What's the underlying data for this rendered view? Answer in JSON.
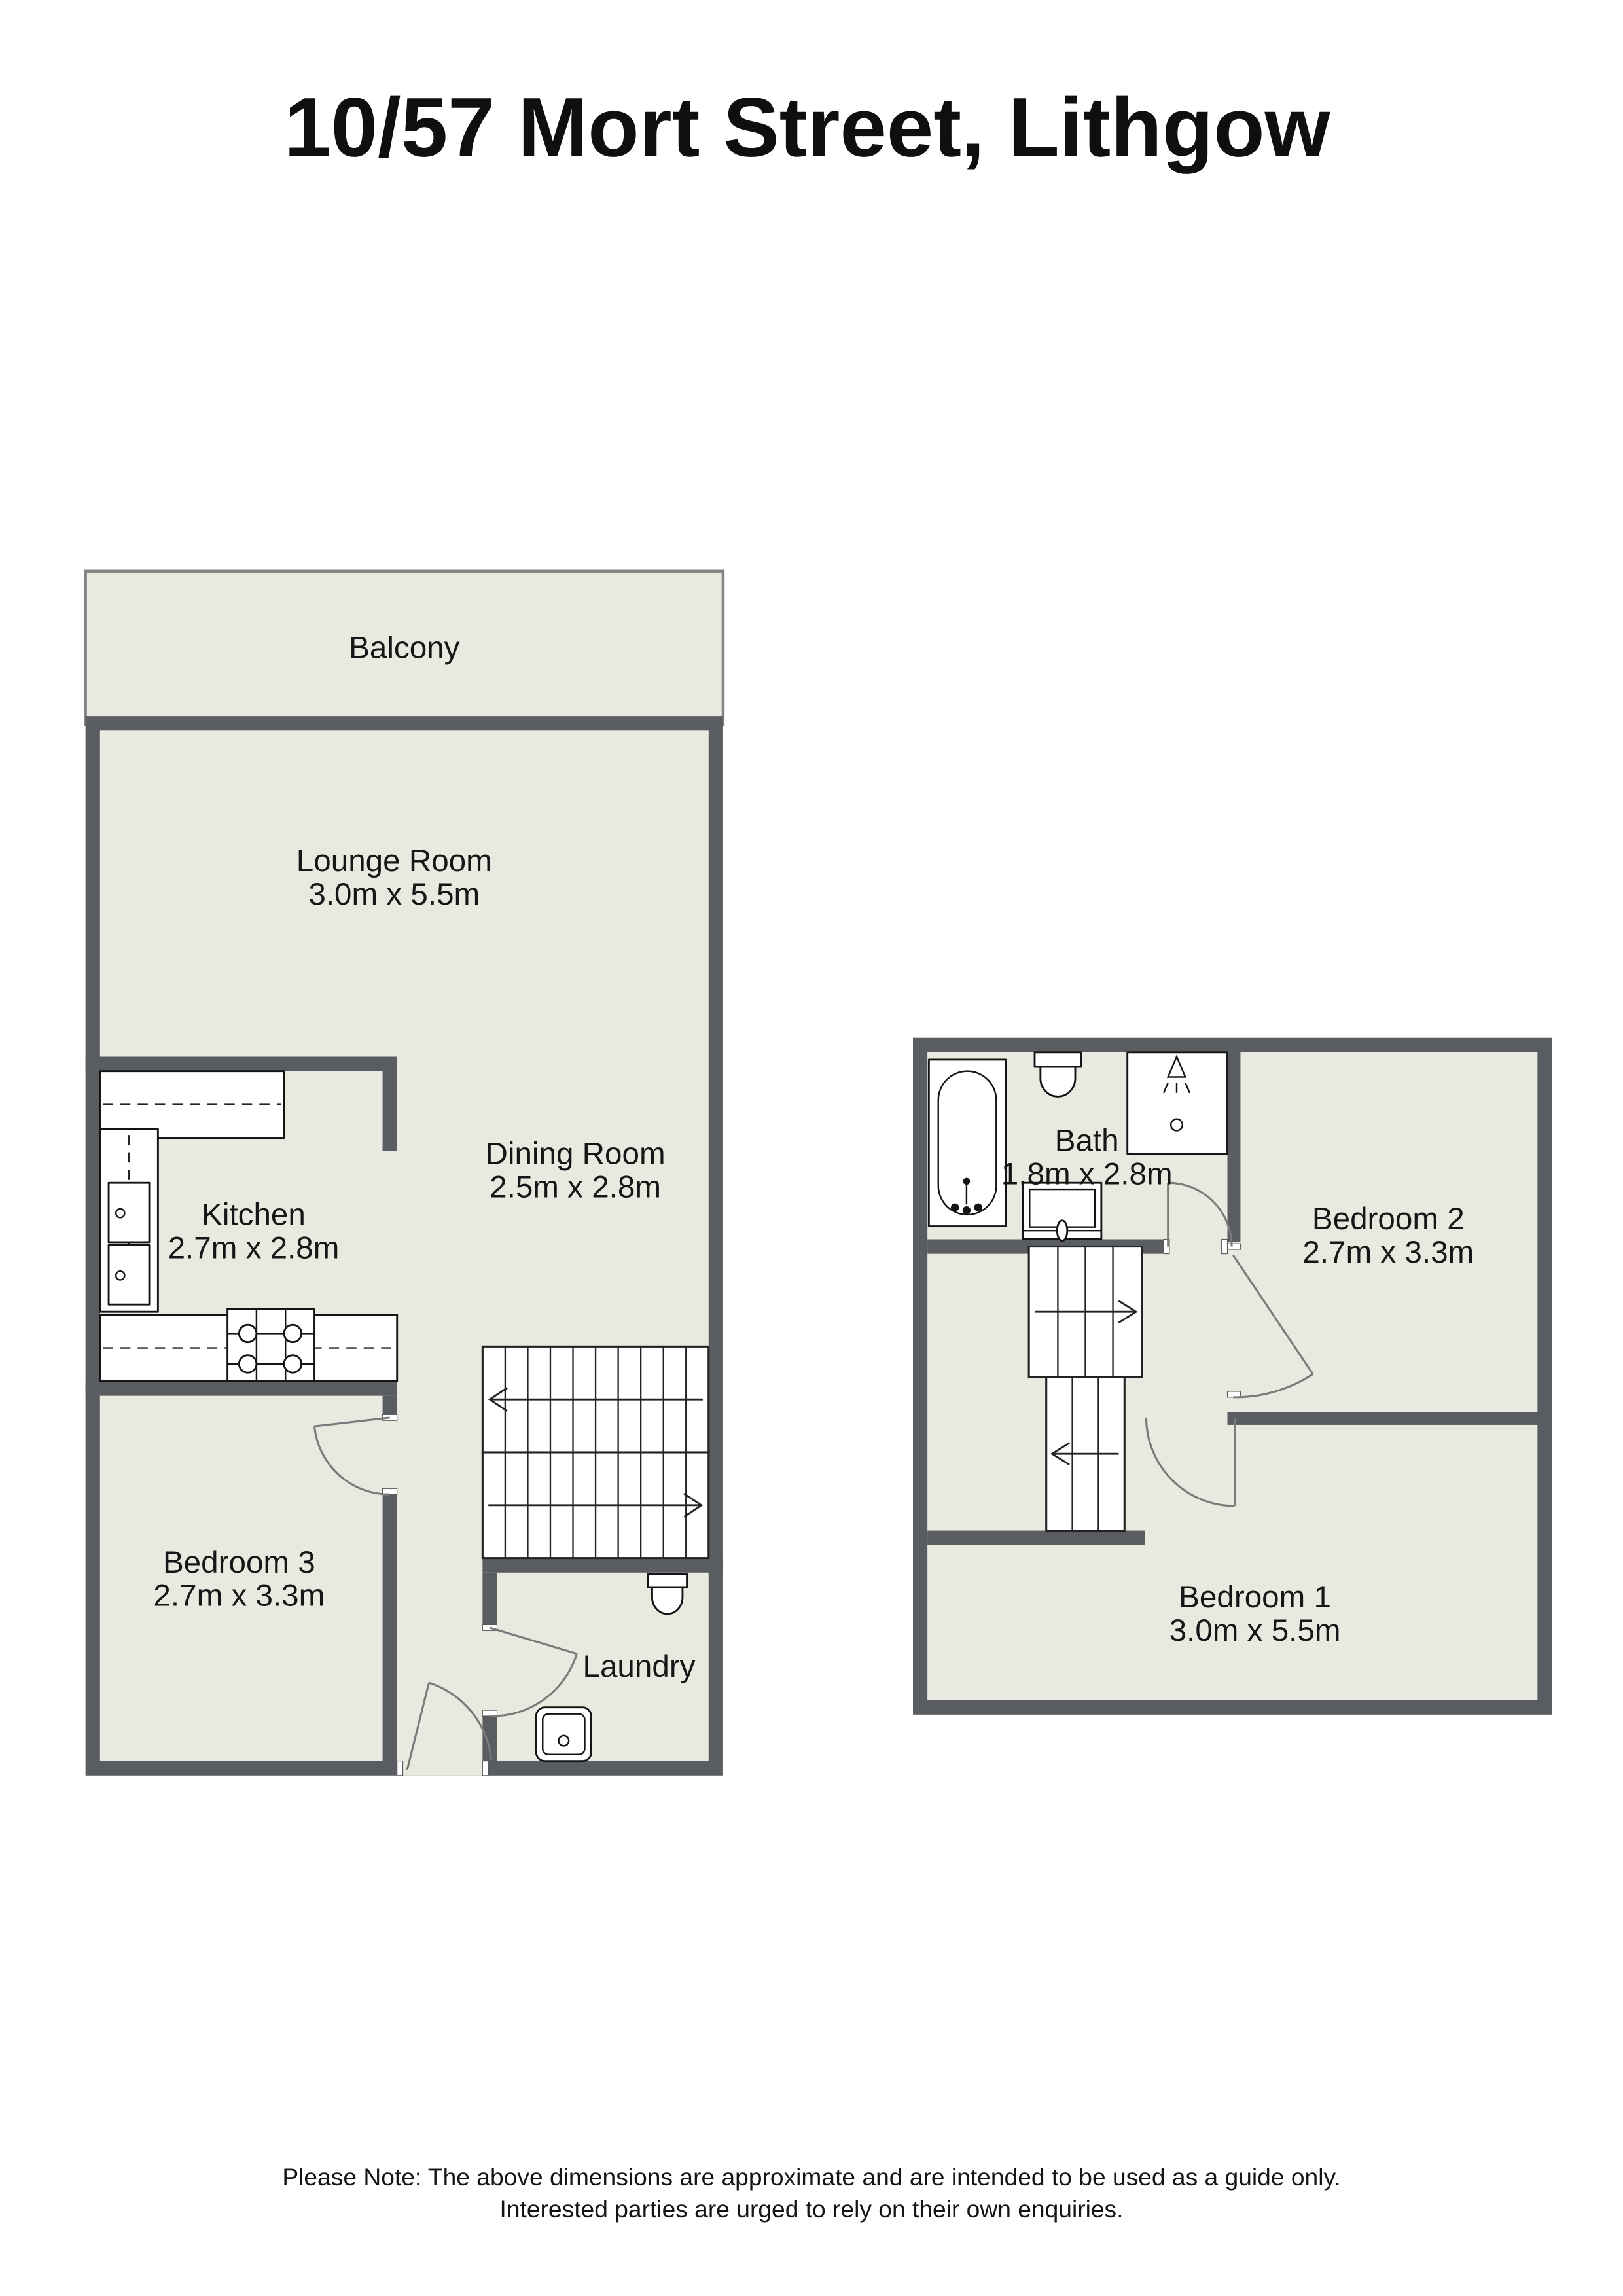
{
  "title": "10/57 Mort Street, Lithgow",
  "balcony_label": "Balcony",
  "rooms": {
    "lounge": {
      "name": "Lounge Room",
      "dims": "3.0m x 5.5m"
    },
    "dining": {
      "name": "Dining Room",
      "dims": "2.5m x 2.8m"
    },
    "kitchen": {
      "name": "Kitchen",
      "dims": "2.7m x 2.8m"
    },
    "bedroom3": {
      "name": "Bedroom 3",
      "dims": "2.7m x 3.3m"
    },
    "laundry": {
      "name": "Laundry"
    },
    "bath": {
      "name": "Bath",
      "dims": "1.8m x 2.8m"
    },
    "bedroom2": {
      "name": "Bedroom 2",
      "dims": "2.7m x 3.3m"
    },
    "bedroom1": {
      "name": "Bedroom 1",
      "dims": "3.0m x 5.5m"
    }
  },
  "note_line1": "Please Note: The above dimensions are approximate and are intended to be used as a guide only.",
  "note_line2": "Interested parties are urged to rely on their own enquiries.",
  "colors": {
    "wall": "#595d61",
    "floor": "#e9e9e0",
    "background": "#ffffff"
  }
}
